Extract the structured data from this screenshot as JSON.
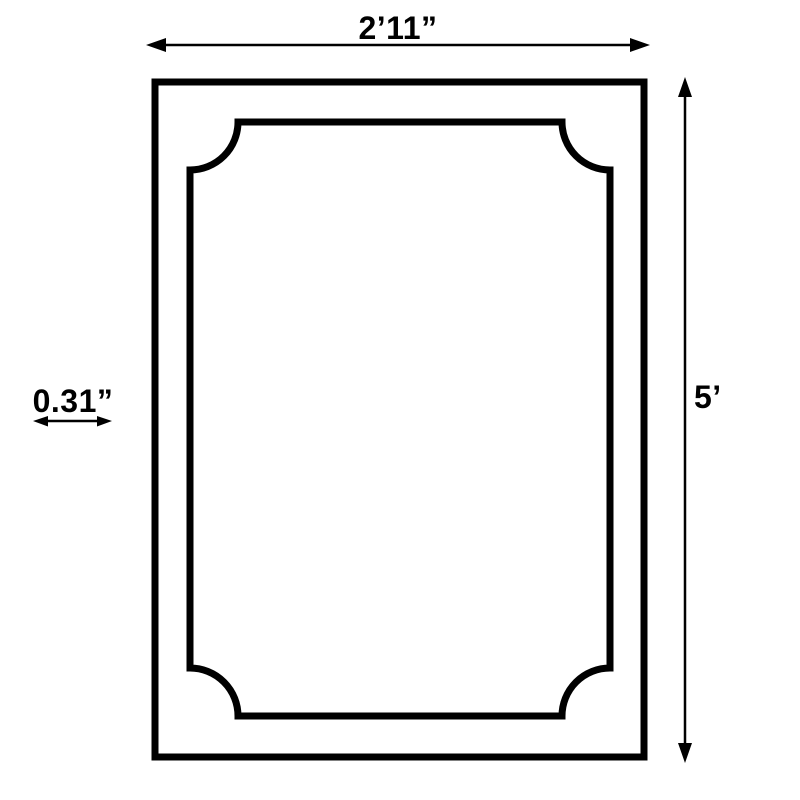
{
  "diagram": {
    "background_color": "#ffffff",
    "line_color": "#000000",
    "object": "rectangular-frame-with-scooped-corner-inner-border",
    "width_dimension": {
      "label": "2’11”"
    },
    "height_dimension": {
      "label": "5’"
    },
    "thickness_dimension": {
      "label": "0.31”"
    }
  }
}
